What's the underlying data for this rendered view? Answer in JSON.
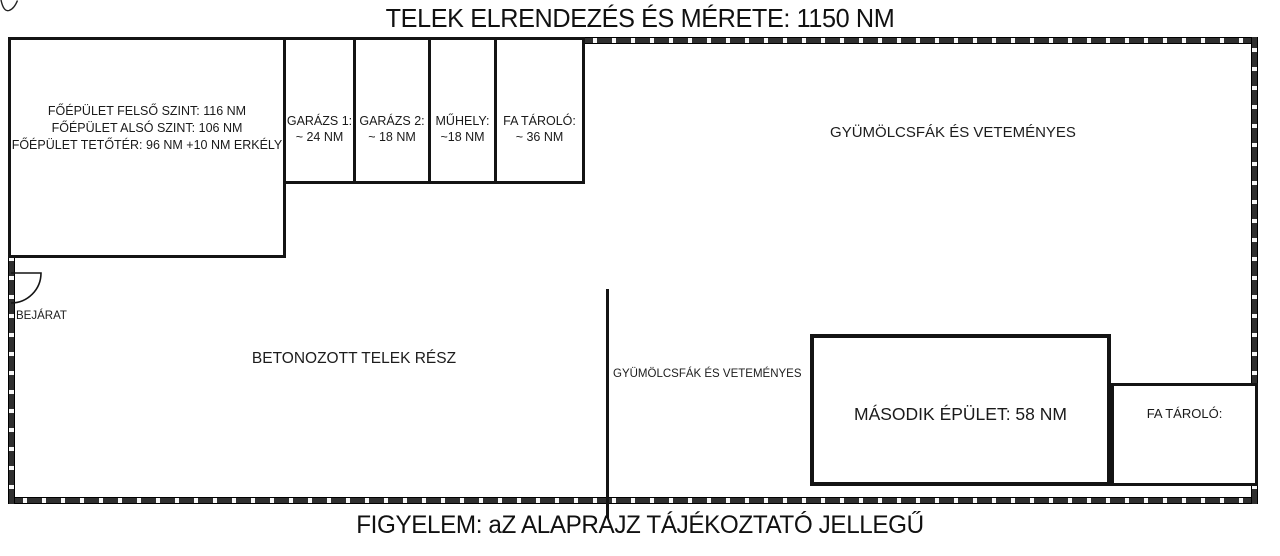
{
  "title": "TELEK ELRENDEZÉS ÉS MÉRETE: 1150 NM",
  "footer_note": "FIGYELEM: aZ ALAPRAJZ TÁJÉKOZTATÓ JELLEGŰ",
  "colors": {
    "line": "#141414",
    "wall_dash": "#2f2f2f",
    "background": "#ffffff",
    "text": "#1a1a1a"
  },
  "main_building": {
    "lines": [
      "FŐÉPÜLET FELSŐ SZINT: 116 NM",
      "FŐÉPÜLET ALSÓ SZINT: 106 NM",
      "FŐÉPÜLET TETŐTÉR: 96 NM +10 NM ERKÉLY"
    ]
  },
  "outbuildings": [
    {
      "name": "GARÁZS 1:",
      "area": "~ 24 NM"
    },
    {
      "name": "GARÁZS 2:",
      "area": "~ 18 NM"
    },
    {
      "name": "MŰHELY:",
      "area": "~18 NM"
    },
    {
      "name": "FA TÁROLÓ:",
      "area": "~ 36 NM"
    }
  ],
  "labels": {
    "orchard_right": "GYÜMÖLCSFÁK ÉS VETEMÉNYES",
    "entrance": "BEJÁRAT",
    "concrete_area": "BETONOZOTT TELEK RÉSZ",
    "orchard_middle": "GYÜMÖLCSFÁK ÉS VETEMÉNYES",
    "second_building": "MÁSODIK ÉPÜLET: 58 NM",
    "wood_storage_right": "FA TÁROLÓ:"
  }
}
